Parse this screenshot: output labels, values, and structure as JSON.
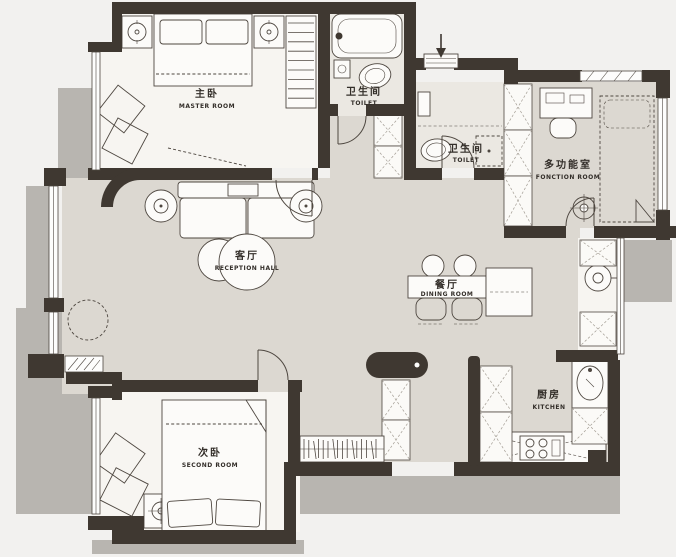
{
  "title": "apartment-floor-plan",
  "colors": {
    "background": "#f2f1ef",
    "shadow": "#b8b5b0",
    "wall": "#3f3831",
    "common_floor": "#dcd8d1",
    "room_floor": "#f7f5f1",
    "bath_floor": "#ebe8e2",
    "line": "#4e4740",
    "text": "#332e29"
  },
  "rooms": {
    "master": {
      "zh": "主卧",
      "en": "MASTER ROOM"
    },
    "toilet_top": {
      "zh": "卫生间",
      "en": "TOILET"
    },
    "toilet_mid": {
      "zh": "卫生间",
      "en": "TOILET"
    },
    "function": {
      "zh": "多功能室",
      "en": "FONCTION ROOM"
    },
    "reception": {
      "zh": "客厅",
      "en": "RECEPTION HALL"
    },
    "dining": {
      "zh": "餐厅",
      "en": "DINING ROOM"
    },
    "second": {
      "zh": "次卧",
      "en": "SECOND ROOM"
    },
    "kitchen": {
      "zh": "厨房",
      "en": "KITCHEN"
    }
  },
  "fixtures": [
    "bathtub",
    "toilet",
    "shower",
    "washbasin",
    "bed",
    "wardrobe",
    "sofa",
    "coffee-table",
    "dining-table",
    "stool",
    "sideboard",
    "bookshelf",
    "stove",
    "kitchen-sink",
    "washing-machine",
    "ceiling-lamp",
    "entry-arrow",
    "doormat",
    "door-arc",
    "window"
  ]
}
